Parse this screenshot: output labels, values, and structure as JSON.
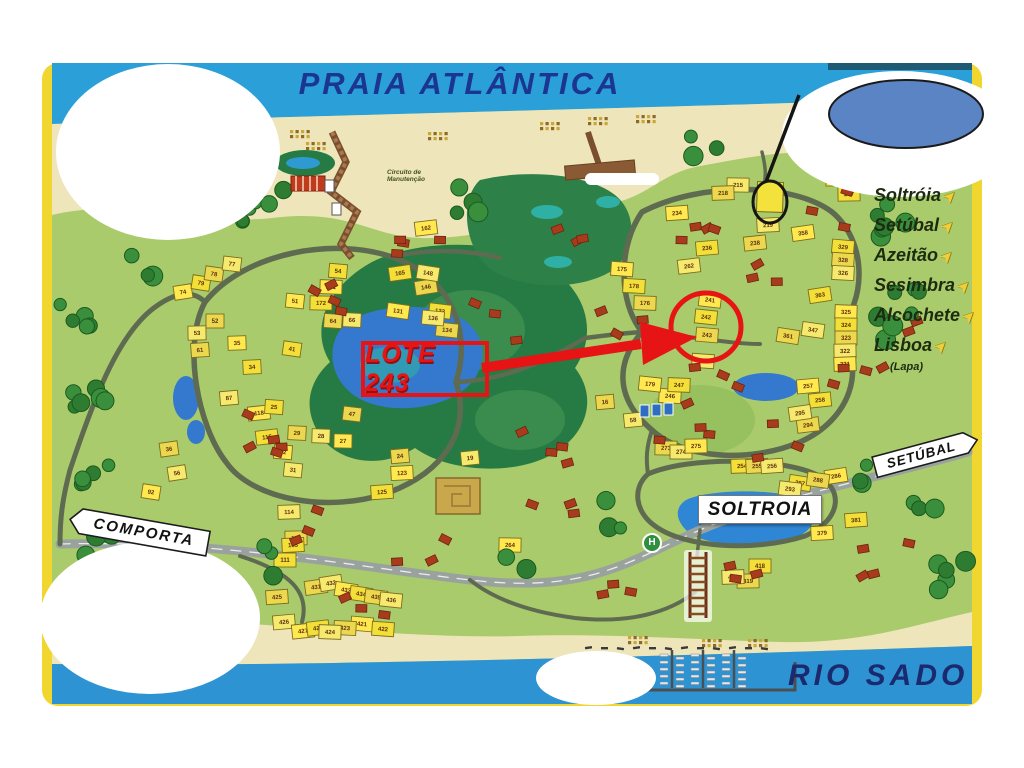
{
  "map": {
    "title": "PRAIA ATLÂNTICA",
    "river_label": "RIO SADO",
    "signs": {
      "comporta": "COMPORTA",
      "setubal": "SETÚBAL",
      "soltroia": "SOLTROIA"
    },
    "destinations": [
      {
        "label": "Soltróia"
      },
      {
        "label": "Setúbal"
      },
      {
        "label": "Azeitão"
      },
      {
        "label": "Sesimbra"
      },
      {
        "label": "Alcochete"
      },
      {
        "label": "Lisboa",
        "sub": "(Lapa)"
      }
    ],
    "annotations": {
      "lot_callout": "LOTE 243"
    },
    "labels": {
      "helipad": "H",
      "circuito": "Circuito de Manutenção"
    },
    "icons": {
      "direction_arrow": "➤"
    },
    "colors": {
      "sky": "#2b9fd8",
      "sand": "#efe5bb",
      "grass": "#aacb6b",
      "forest": "#2d7c31",
      "water": "#3579cf",
      "lot_yellow": "#f2df38",
      "roof_red": "#a93b1d",
      "annotation_red": "#e61414",
      "title_navy": "#1b3590",
      "frame_yellow": "#f0d62e",
      "redaction_oval_blue": "#5b84c4"
    },
    "lots": [
      {
        "n": "74",
        "x": 183,
        "y": 292
      },
      {
        "n": "79",
        "x": 201,
        "y": 283
      },
      {
        "n": "78",
        "x": 214,
        "y": 274
      },
      {
        "n": "77",
        "x": 232,
        "y": 264
      },
      {
        "n": "51",
        "x": 295,
        "y": 301
      },
      {
        "n": "54",
        "x": 338,
        "y": 271
      },
      {
        "n": "64",
        "x": 333,
        "y": 321
      },
      {
        "n": "66",
        "x": 352,
        "y": 320
      },
      {
        "n": "171",
        "x": 331,
        "y": 287
      },
      {
        "n": "172",
        "x": 321,
        "y": 303
      },
      {
        "n": "52",
        "x": 215,
        "y": 321
      },
      {
        "n": "53",
        "x": 197,
        "y": 333
      },
      {
        "n": "35",
        "x": 237,
        "y": 343
      },
      {
        "n": "34",
        "x": 252,
        "y": 367
      },
      {
        "n": "61",
        "x": 200,
        "y": 350
      },
      {
        "n": "87",
        "x": 229,
        "y": 398
      },
      {
        "n": "118",
        "x": 259,
        "y": 413
      },
      {
        "n": "115",
        "x": 267,
        "y": 437
      },
      {
        "n": "36",
        "x": 169,
        "y": 449
      },
      {
        "n": "56",
        "x": 177,
        "y": 473
      },
      {
        "n": "92",
        "x": 151,
        "y": 492
      },
      {
        "n": "41",
        "x": 292,
        "y": 349
      },
      {
        "n": "47",
        "x": 352,
        "y": 414
      },
      {
        "n": "31",
        "x": 293,
        "y": 470
      },
      {
        "n": "32",
        "x": 283,
        "y": 452
      },
      {
        "n": "25",
        "x": 274,
        "y": 407
      },
      {
        "n": "29",
        "x": 297,
        "y": 433
      },
      {
        "n": "28",
        "x": 321,
        "y": 436
      },
      {
        "n": "27",
        "x": 343,
        "y": 441
      },
      {
        "n": "111",
        "x": 285,
        "y": 560
      },
      {
        "n": "113",
        "x": 296,
        "y": 538
      },
      {
        "n": "114",
        "x": 289,
        "y": 512
      },
      {
        "n": "123",
        "x": 402,
        "y": 473
      },
      {
        "n": "125",
        "x": 382,
        "y": 492
      },
      {
        "n": "24",
        "x": 400,
        "y": 456
      },
      {
        "n": "19",
        "x": 470,
        "y": 458
      },
      {
        "n": "162",
        "x": 426,
        "y": 228
      },
      {
        "n": "165",
        "x": 400,
        "y": 273
      },
      {
        "n": "146",
        "x": 426,
        "y": 287
      },
      {
        "n": "148",
        "x": 428,
        "y": 273
      },
      {
        "n": "131",
        "x": 398,
        "y": 311
      },
      {
        "n": "133",
        "x": 440,
        "y": 311
      },
      {
        "n": "134",
        "x": 447,
        "y": 330
      },
      {
        "n": "136",
        "x": 433,
        "y": 318
      },
      {
        "n": "175",
        "x": 622,
        "y": 269
      },
      {
        "n": "178",
        "x": 634,
        "y": 286
      },
      {
        "n": "176",
        "x": 645,
        "y": 303
      },
      {
        "n": "215",
        "x": 738,
        "y": 185
      },
      {
        "n": "216",
        "x": 837,
        "y": 179
      },
      {
        "n": "217",
        "x": 849,
        "y": 194
      },
      {
        "n": "218",
        "x": 723,
        "y": 193
      },
      {
        "n": "219",
        "x": 768,
        "y": 225
      },
      {
        "n": "234",
        "x": 677,
        "y": 213
      },
      {
        "n": "236",
        "x": 707,
        "y": 248
      },
      {
        "n": "238",
        "x": 755,
        "y": 243
      },
      {
        "n": "262",
        "x": 689,
        "y": 266
      },
      {
        "n": "358",
        "x": 803,
        "y": 233
      },
      {
        "n": "363",
        "x": 820,
        "y": 295
      },
      {
        "n": "361",
        "x": 788,
        "y": 336
      },
      {
        "n": "347",
        "x": 813,
        "y": 330
      },
      {
        "n": "241",
        "x": 710,
        "y": 300
      },
      {
        "n": "242",
        "x": 706,
        "y": 317
      },
      {
        "n": "243",
        "x": 707,
        "y": 335
      },
      {
        "n": "245",
        "x": 703,
        "y": 361
      },
      {
        "n": "246",
        "x": 670,
        "y": 396
      },
      {
        "n": "247",
        "x": 679,
        "y": 385
      },
      {
        "n": "273",
        "x": 666,
        "y": 448
      },
      {
        "n": "274",
        "x": 681,
        "y": 452
      },
      {
        "n": "275",
        "x": 696,
        "y": 446
      },
      {
        "n": "254",
        "x": 742,
        "y": 466
      },
      {
        "n": "255",
        "x": 757,
        "y": 466
      },
      {
        "n": "256",
        "x": 772,
        "y": 466
      },
      {
        "n": "257",
        "x": 808,
        "y": 386
      },
      {
        "n": "258",
        "x": 820,
        "y": 400
      },
      {
        "n": "294",
        "x": 808,
        "y": 425
      },
      {
        "n": "295",
        "x": 800,
        "y": 413
      },
      {
        "n": "286",
        "x": 836,
        "y": 476
      },
      {
        "n": "287",
        "x": 800,
        "y": 483
      },
      {
        "n": "288",
        "x": 818,
        "y": 480
      },
      {
        "n": "293",
        "x": 790,
        "y": 489
      },
      {
        "n": "179",
        "x": 650,
        "y": 384
      },
      {
        "n": "329",
        "x": 843,
        "y": 247
      },
      {
        "n": "328",
        "x": 843,
        "y": 260
      },
      {
        "n": "326",
        "x": 843,
        "y": 273
      },
      {
        "n": "325",
        "x": 846,
        "y": 312
      },
      {
        "n": "324",
        "x": 846,
        "y": 325
      },
      {
        "n": "323",
        "x": 846,
        "y": 338
      },
      {
        "n": "322",
        "x": 845,
        "y": 351
      },
      {
        "n": "321",
        "x": 845,
        "y": 364
      },
      {
        "n": "163",
        "x": 293,
        "y": 545
      },
      {
        "n": "425",
        "x": 277,
        "y": 597
      },
      {
        "n": "426",
        "x": 284,
        "y": 622
      },
      {
        "n": "427",
        "x": 303,
        "y": 631
      },
      {
        "n": "428",
        "x": 318,
        "y": 628
      },
      {
        "n": "431",
        "x": 316,
        "y": 587
      },
      {
        "n": "432",
        "x": 331,
        "y": 583
      },
      {
        "n": "433",
        "x": 346,
        "y": 590
      },
      {
        "n": "434",
        "x": 361,
        "y": 594
      },
      {
        "n": "435",
        "x": 376,
        "y": 597
      },
      {
        "n": "436",
        "x": 391,
        "y": 600
      },
      {
        "n": "421",
        "x": 362,
        "y": 624
      },
      {
        "n": "422",
        "x": 383,
        "y": 629
      },
      {
        "n": "423",
        "x": 345,
        "y": 628
      },
      {
        "n": "424",
        "x": 330,
        "y": 632
      },
      {
        "n": "264",
        "x": 510,
        "y": 545
      },
      {
        "n": "418",
        "x": 760,
        "y": 566
      },
      {
        "n": "419",
        "x": 748,
        "y": 581
      },
      {
        "n": "420",
        "x": 733,
        "y": 577
      },
      {
        "n": "379",
        "x": 822,
        "y": 533
      },
      {
        "n": "381",
        "x": 856,
        "y": 520
      },
      {
        "n": "16",
        "x": 605,
        "y": 402
      },
      {
        "n": "58",
        "x": 633,
        "y": 420
      }
    ]
  }
}
